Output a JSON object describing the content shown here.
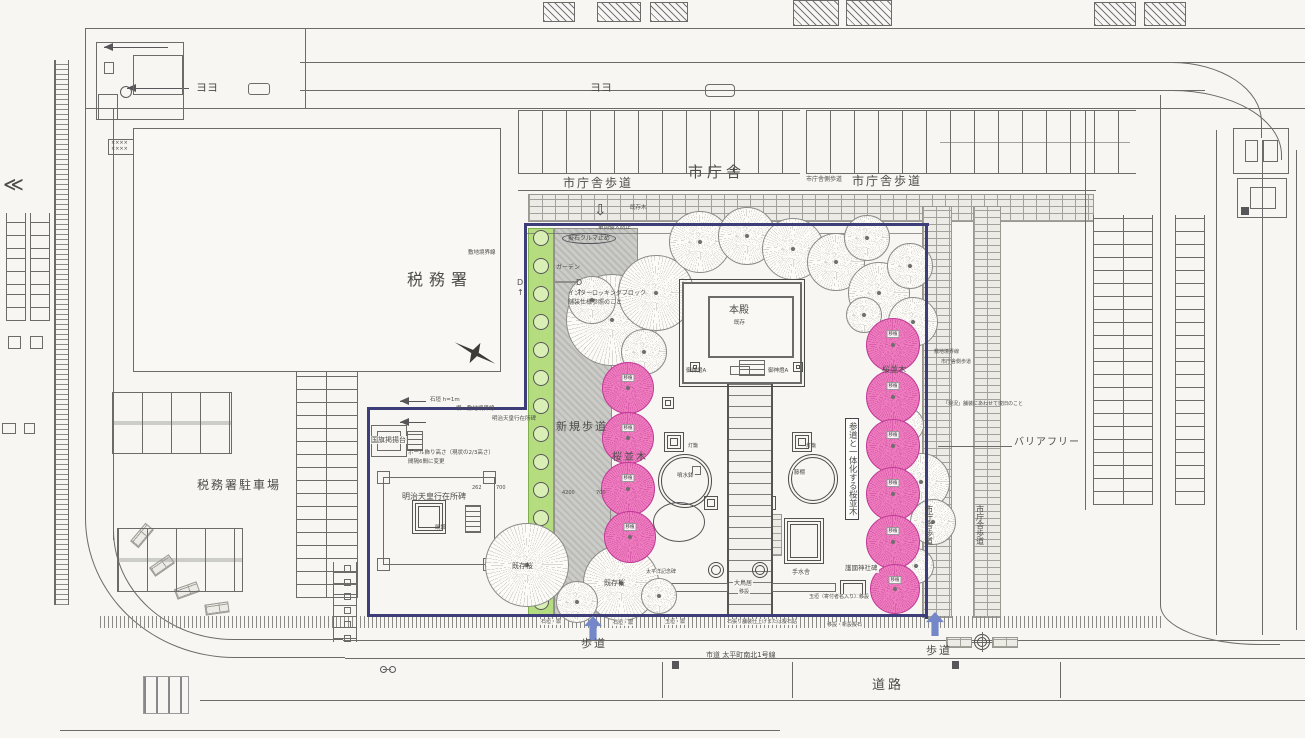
{
  "colors": {
    "paper": "#f7f6f2",
    "ink": "#4c4c4a",
    "ln": "#6b6b69",
    "boundary": "#3d3d7a",
    "cherry": "#f07fc1",
    "cherrystroke": "#c03896",
    "green": "#b5dd7f",
    "blue": "#7487c9"
  },
  "trees": {
    "chip": "移植",
    "existing": [
      [
        612,
        320,
        46
      ],
      [
        656,
        293,
        38
      ],
      [
        700,
        242,
        31
      ],
      [
        747,
        236,
        29
      ],
      [
        793,
        249,
        31
      ],
      [
        836,
        262,
        29
      ],
      [
        867,
        238,
        23
      ],
      [
        879,
        293,
        31
      ],
      [
        910,
        266,
        23
      ],
      [
        913,
        322,
        25
      ],
      [
        644,
        352,
        23
      ],
      [
        592,
        300,
        24
      ],
      [
        864,
        315,
        18
      ],
      [
        906,
        425,
        18
      ],
      [
        921,
        482,
        29
      ],
      [
        933,
        522,
        23
      ],
      [
        916,
        566,
        18
      ],
      [
        527,
        565,
        42
      ],
      [
        621,
        583,
        38
      ],
      [
        577,
        602,
        21
      ],
      [
        659,
        596,
        18
      ]
    ],
    "cherry": [
      [
        628,
        388,
        26
      ],
      [
        628,
        438,
        26
      ],
      [
        628,
        489,
        27
      ],
      [
        630,
        537,
        26
      ],
      [
        893,
        345,
        27
      ],
      [
        893,
        397,
        27
      ],
      [
        893,
        446,
        27
      ],
      [
        893,
        494,
        27
      ],
      [
        893,
        542,
        27
      ],
      [
        895,
        589,
        25
      ]
    ]
  },
  "labels": [
    {
      "name": "city-hall-label",
      "text": "市庁舎",
      "x": 688,
      "y": 163,
      "s": 15,
      "ls": 4
    },
    {
      "name": "city-hall-walk-left",
      "text": "市庁舎歩道",
      "x": 563,
      "y": 176,
      "s": 12,
      "ls": 2
    },
    {
      "name": "city-hall-walk-right",
      "text": "市庁舎歩道",
      "x": 852,
      "y": 174,
      "s": 12,
      "ls": 2
    },
    {
      "name": "city-hall-side-walk-note",
      "text": "市庁舎側歩道",
      "x": 806,
      "y": 176,
      "s": 6
    },
    {
      "name": "tax-office-label",
      "text": "税務署",
      "x": 407,
      "y": 270,
      "s": 16,
      "ls": 6
    },
    {
      "name": "tax-office-parking-label",
      "text": "税務署駐車場",
      "x": 197,
      "y": 478,
      "s": 12,
      "ls": 2
    },
    {
      "name": "site-boundary-note",
      "text": "敷地境界線",
      "x": 468,
      "y": 250,
      "s": 5.5
    },
    {
      "name": "honden-label",
      "text": "本殿",
      "x": 729,
      "y": 305,
      "s": 10
    },
    {
      "name": "honden-sub",
      "text": "既存",
      "x": 734,
      "y": 320,
      "s": 5.5
    },
    {
      "name": "lantern-a-left",
      "text": "御神燈A",
      "x": 686,
      "y": 368,
      "s": 5.5
    },
    {
      "name": "lantern-a-right",
      "text": "御神燈A",
      "x": 768,
      "y": 368,
      "s": 5.5
    },
    {
      "name": "new-sidewalk-label",
      "text": "新規歩道",
      "x": 556,
      "y": 420,
      "s": 11,
      "ls": 2
    },
    {
      "name": "sakura-row-center",
      "text": "桜並木",
      "x": 612,
      "y": 452,
      "s": 10,
      "ls": 2
    },
    {
      "name": "sakura-row-right",
      "text": "桜並木",
      "x": 882,
      "y": 365,
      "s": 8
    },
    {
      "name": "sando-cherry-note",
      "text": "参道と一体化する桜並木",
      "x": 845,
      "y": 418,
      "s": 8.5,
      "v": true,
      "box": true
    },
    {
      "name": "barrier-free-label",
      "text": "バリアフリー",
      "x": 1014,
      "y": 437,
      "s": 10,
      "ls": 1
    },
    {
      "name": "walk-vertical-a",
      "text": "市庁舎歩道",
      "x": 924,
      "y": 505,
      "s": 8,
      "v": true
    },
    {
      "name": "walk-vertical-b",
      "text": "市庁舎歩道",
      "x": 975,
      "y": 505,
      "s": 8,
      "v": true
    },
    {
      "name": "boundary-tiny",
      "text": "敷地境界線",
      "x": 934,
      "y": 349,
      "s": 5
    },
    {
      "name": "side-walk-tiny",
      "text": "市庁舎側歩道",
      "x": 941,
      "y": 359,
      "s": 5
    },
    {
      "name": "pavement-note",
      "text": "「現況」舗装にあわせて復旧のこと",
      "x": 943,
      "y": 401,
      "s": 5
    },
    {
      "name": "walk-label-left",
      "text": "歩道",
      "x": 581,
      "y": 637,
      "s": 11,
      "ls": 2
    },
    {
      "name": "walk-label-right",
      "text": "歩道",
      "x": 926,
      "y": 644,
      "s": 11,
      "ls": 2
    },
    {
      "name": "road-label",
      "text": "道路",
      "x": 872,
      "y": 678,
      "s": 13,
      "ls": 3
    },
    {
      "name": "road-name",
      "text": "市道 太平町南北1号線",
      "x": 706,
      "y": 651,
      "s": 7
    },
    {
      "name": "leader-ishigaki-1",
      "text": "石垣・塀",
      "x": 540,
      "y": 619,
      "s": 5,
      "bg": true
    },
    {
      "name": "leader-ishigaki-2",
      "text": "石垣・塀",
      "x": 612,
      "y": 620,
      "s": 5,
      "bg": true
    },
    {
      "name": "leader-tamagaki",
      "text": "玉垣・塀",
      "x": 664,
      "y": 619,
      "s": 5,
      "bg": true
    },
    {
      "name": "leader-stone-paving",
      "text": "石張り舗装仕上げまたは擬石貼",
      "x": 726,
      "y": 619,
      "s": 5,
      "bg": true
    },
    {
      "name": "leader-relocate-stone",
      "text": "移設・新設擬石",
      "x": 826,
      "y": 622,
      "s": 5,
      "bg": true
    },
    {
      "name": "gokoku-monument",
      "text": "護國神社碑",
      "x": 844,
      "y": 565,
      "s": 6.5,
      "bg": true
    },
    {
      "name": "tamagaki-note",
      "text": "玉垣（寄付者名入り）移設",
      "x": 808,
      "y": 594,
      "s": 5,
      "bg": true
    },
    {
      "name": "otorii-label",
      "text": "大鳥居",
      "x": 733,
      "y": 580,
      "s": 6,
      "bg": true
    },
    {
      "name": "otorii-sub",
      "text": "移設",
      "x": 738,
      "y": 589,
      "s": 5,
      "bg": true
    },
    {
      "name": "existing-sakura-1",
      "text": "既存桜",
      "x": 512,
      "y": 562,
      "s": 7
    },
    {
      "name": "existing-sakura-2",
      "text": "既存桜",
      "x": 604,
      "y": 579,
      "s": 7
    },
    {
      "name": "memorial-label",
      "text": "太平洋記念碑",
      "x": 645,
      "y": 569,
      "s": 5,
      "bg": true
    },
    {
      "name": "garden-label",
      "text": "ガーデン",
      "x": 556,
      "y": 264,
      "s": 6
    },
    {
      "name": "interlocking-label",
      "text": "インターロッキングブロック",
      "x": 568,
      "y": 290,
      "s": 6
    },
    {
      "name": "interlocking-sub",
      "text": "舗装仕様参照のこと",
      "x": 568,
      "y": 299,
      "s": 6
    },
    {
      "name": "car-stop-label",
      "text": "擬石クルマ止め",
      "x": 562,
      "y": 233,
      "s": 6,
      "oval": true
    },
    {
      "name": "no-entry-note",
      "text": "車両侵入防止",
      "x": 598,
      "y": 225,
      "s": 5.5
    },
    {
      "name": "existing-tree-note",
      "text": "既存木",
      "x": 630,
      "y": 205,
      "s": 5.5
    },
    {
      "name": "stone-wall-note",
      "text": "石垣 h=1m",
      "x": 430,
      "y": 397,
      "s": 5.5
    },
    {
      "name": "fence-boundary-note",
      "text": "塀・敷地境界線",
      "x": 456,
      "y": 406,
      "s": 5.5
    },
    {
      "name": "flag-stand-label",
      "text": "国旗掲揚台",
      "x": 370,
      "y": 436,
      "s": 7,
      "bg": true
    },
    {
      "name": "pole-note-1",
      "text": "ポール飾り高さ（現状の2/3高さ）",
      "x": 408,
      "y": 450,
      "s": 5.5
    },
    {
      "name": "pole-note-2",
      "text": "間隔6間に変更",
      "x": 408,
      "y": 459,
      "s": 5.5
    },
    {
      "name": "meiji-monument-label",
      "text": "明治天皇行在所碑",
      "x": 402,
      "y": 492,
      "s": 8
    },
    {
      "name": "existing-set-note",
      "text": "既設",
      "x": 435,
      "y": 525,
      "s": 5.5
    },
    {
      "name": "meiji-leader-note",
      "text": "明治天皇行在所碑",
      "x": 492,
      "y": 416,
      "s": 5.5
    },
    {
      "name": "fountain-label",
      "text": "噴水鉢",
      "x": 676,
      "y": 473,
      "s": 5.5,
      "bg": true
    },
    {
      "name": "fujidana-label",
      "text": "藤棚",
      "x": 793,
      "y": 470,
      "s": 5.5,
      "bg": true
    },
    {
      "name": "chozuya-label",
      "text": "手水舎",
      "x": 791,
      "y": 569,
      "s": 6,
      "bg": true
    },
    {
      "name": "toro-1",
      "text": "灯籠",
      "x": 688,
      "y": 443,
      "s": 5
    },
    {
      "name": "toro-2",
      "text": "灯籠",
      "x": 806,
      "y": 443,
      "s": 5
    },
    {
      "name": "dim-262",
      "text": "262",
      "x": 472,
      "y": 485,
      "s": 5
    },
    {
      "name": "dim-700a",
      "text": "700",
      "x": 496,
      "y": 485,
      "s": 5
    },
    {
      "name": "dim-4200",
      "text": "4200",
      "x": 562,
      "y": 490,
      "s": 5
    },
    {
      "name": "dim-700b",
      "text": "700",
      "x": 596,
      "y": 490,
      "s": 5
    },
    {
      "name": "section-d-1",
      "text": "D\n↑",
      "x": 517,
      "y": 278,
      "s": 8
    },
    {
      "name": "section-d-2",
      "text": "D\n↑",
      "x": 576,
      "y": 278,
      "s": 8
    },
    {
      "name": "hollow-arrow-down",
      "text": "⇩",
      "x": 594,
      "y": 201,
      "s": 15
    },
    {
      "name": "road-chevron",
      "text": "≪",
      "x": 3,
      "y": 172,
      "s": 20
    },
    {
      "name": "road-mark-yo-1",
      "text": "ヨヨ",
      "x": 196,
      "y": 81,
      "s": 11
    },
    {
      "name": "road-mark-yo-2",
      "text": "ヨヨ",
      "x": 590,
      "y": 81,
      "s": 11
    },
    {
      "name": "xxxx-mark",
      "text": "××××\n××××",
      "x": 111,
      "y": 140,
      "s": 5
    }
  ]
}
